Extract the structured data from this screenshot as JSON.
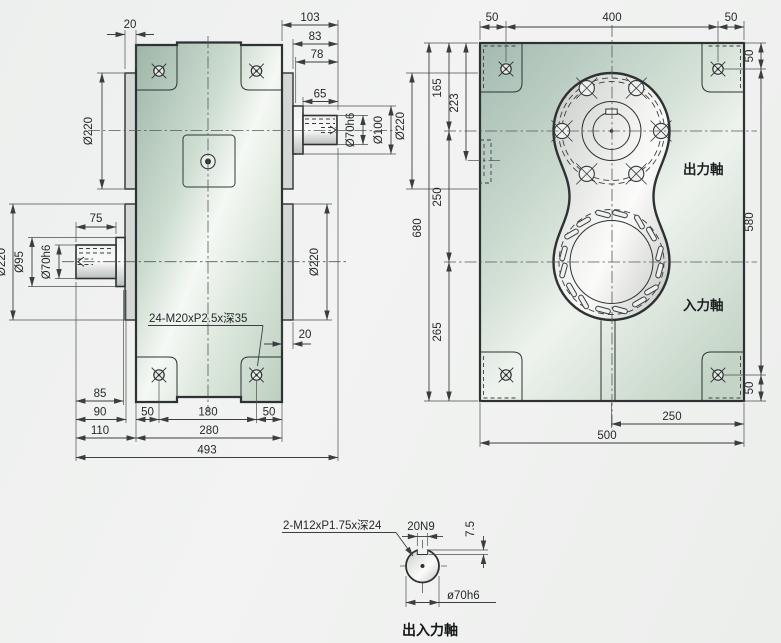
{
  "drawing": {
    "side_view": {
      "dim_20_top": "20",
      "dim_103": "103",
      "dim_83": "83",
      "dim_78": "78",
      "dim_65": "65",
      "dia_220_output": "Ø220",
      "dia_70h6_output": "Ø70h6",
      "dia_100_output": "Ø100",
      "dim_75": "75",
      "dia_220_input_left": "Ø220",
      "dia_95_input": "Ø95",
      "dia_70h6_input": "Ø70h6",
      "dia_220_input_right": "Ø220",
      "thread_note": "24-M20xP2.5x深35",
      "dim_20_bottom": "20",
      "dim_85": "85",
      "dim_90": "90",
      "dim_110": "110",
      "dim_50_left": "50",
      "dim_180": "180",
      "dim_50_right": "50",
      "dim_280": "280",
      "dim_493": "493"
    },
    "front_view": {
      "dim_50_top_left": "50",
      "dim_400": "400",
      "dim_50_top_right": "50",
      "dim_50_right_top": "50",
      "dim_580": "580",
      "dim_50_right_bottom": "50",
      "dia_220": "Ø220",
      "dim_680": "680",
      "dim_165": "165",
      "dim_223": "223",
      "dim_250_left": "250",
      "dim_265": "265",
      "label_output_shaft": "出力軸",
      "label_input_shaft": "入力軸",
      "dim_250_bottom": "250",
      "dim_500": "500"
    },
    "shaft_detail": {
      "thread_note": "2-M12xP1.75x深24",
      "key_width": "20N9",
      "key_depth": "7.5",
      "shaft_dia": "ø70h6",
      "caption": "出入力軸"
    },
    "colors": {
      "housing_green": "#a8bfb0",
      "metal_silver": "#d8dad8",
      "line_dark": "#2e3234"
    }
  }
}
